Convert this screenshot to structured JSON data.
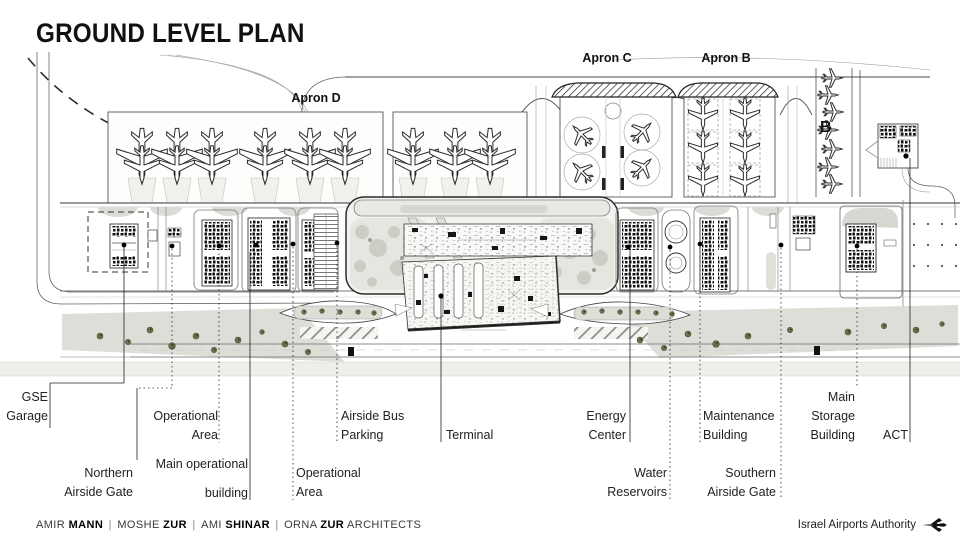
{
  "title": "GROUND LEVEL PLAN",
  "plan": {
    "apron_labels": [
      {
        "id": "apron-d",
        "text": "Apron D",
        "x": 316,
        "y": 91
      },
      {
        "id": "apron-c",
        "text": "Apron C",
        "x": 607,
        "y": 51
      },
      {
        "id": "apron-b",
        "text": "Apron B",
        "x": 726,
        "y": 51
      }
    ],
    "marker_b": {
      "text": "B",
      "x": 820,
      "y": 119
    },
    "callouts": [
      {
        "id": "gse-garage",
        "lines": [
          "GSE",
          "Garage"
        ],
        "align": "right",
        "x": 48,
        "y": 388
      },
      {
        "id": "northern-airside-gate",
        "lines": [
          "Northern",
          "Airside Gate"
        ],
        "align": "right",
        "x": 133,
        "y": 464
      },
      {
        "id": "operational-area-1",
        "lines": [
          "Operational",
          "Area"
        ],
        "align": "right",
        "x": 218,
        "y": 407
      },
      {
        "id": "main-operational-building",
        "lines": [
          "Main operational",
          "building"
        ],
        "align": "right",
        "x": 248,
        "y": 455,
        "gap": true
      },
      {
        "id": "operational-area-2",
        "lines": [
          "Operational",
          "Area"
        ],
        "align": "left",
        "x": 296,
        "y": 464
      },
      {
        "id": "airside-bus-parking",
        "lines": [
          "Airside Bus",
          "Parking"
        ],
        "align": "left",
        "x": 341,
        "y": 407
      },
      {
        "id": "terminal",
        "lines": [
          "Terminal"
        ],
        "align": "left",
        "x": 446,
        "y": 426
      },
      {
        "id": "energy-center",
        "lines": [
          "Energy",
          "Center"
        ],
        "align": "right",
        "x": 626,
        "y": 407
      },
      {
        "id": "water-reservoirs",
        "lines": [
          "Water",
          "Reservoirs"
        ],
        "align": "right",
        "x": 667,
        "y": 464
      },
      {
        "id": "maintenance-building",
        "lines": [
          "Maintenance",
          "Building"
        ],
        "align": "left",
        "x": 703,
        "y": 407
      },
      {
        "id": "southern-airside-gate",
        "lines": [
          "Southern",
          "Airside Gate"
        ],
        "align": "right",
        "x": 776,
        "y": 464
      },
      {
        "id": "main-storage-building",
        "lines": [
          "Main",
          "Storage",
          "Building"
        ],
        "align": "right",
        "x": 855,
        "y": 388
      },
      {
        "id": "act",
        "lines": [
          "ACT"
        ],
        "align": "right",
        "x": 908,
        "y": 426
      }
    ]
  },
  "footer": {
    "credits": [
      {
        "text": "AMIR ",
        "bold": false
      },
      {
        "text": "MANN",
        "bold": true
      },
      {
        "text": " | ",
        "sep": true
      },
      {
        "text": "MOSHE ",
        "bold": false
      },
      {
        "text": "ZUR",
        "bold": true
      },
      {
        "text": " | ",
        "sep": true
      },
      {
        "text": "AMI ",
        "bold": false
      },
      {
        "text": "SHINAR",
        "bold": true
      },
      {
        "text": " | ",
        "sep": true
      },
      {
        "text": "ORNA ",
        "bold": false
      },
      {
        "text": "ZUR",
        "bold": true
      },
      {
        "text": " ARCHITECTS",
        "bold": false
      }
    ],
    "authority": "Israel Airports Authority",
    "logo_icon": "iaa-plane-icon"
  },
  "colors": {
    "ink": "#1c1c1c",
    "line": "#555555",
    "light_fill": "#e3e3de",
    "pavement": "#dcdcd7",
    "tree": "#6f6f4d"
  }
}
